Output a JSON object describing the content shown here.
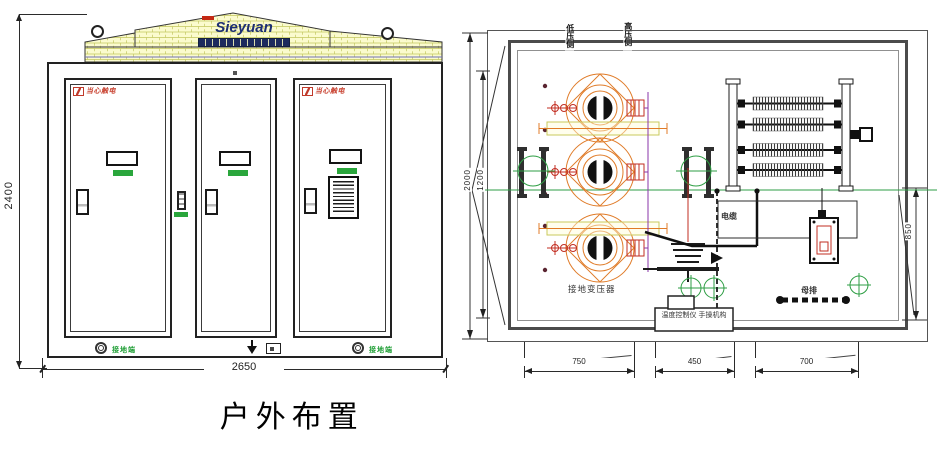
{
  "title": "户外布置",
  "front": {
    "logo": "Sieyuan",
    "dim_height": "2400",
    "dim_width": "2650",
    "warning": "当心触电",
    "ground_label": "接地端"
  },
  "plan": {
    "dim_total_height": "2000",
    "dim_inner_height": "1200",
    "dim_right_height": "850",
    "dim_bottom_1": "750",
    "dim_bottom_2": "450",
    "dim_bottom_3": "700",
    "top_label_left": "低压侧",
    "top_label_right": "高压侧",
    "cable_label": "电缆",
    "bus_label": "母排",
    "transformer_label": "接地变压器",
    "control_label": "温度控制仪 手操机构"
  },
  "colors": {
    "line": "#2b2b2b",
    "brick_fill": "#fbfbce",
    "brick_joint": "#c3c75f",
    "logo_blue": "#1d2f73",
    "warning_red": "#c8402e",
    "indicator_green": "#2aa63c",
    "centerline_green": "#2e9e44",
    "coil_orange": "#e07b28",
    "bushing_red": "#c22e22",
    "connector_purple": "#8a36aa",
    "wall_gray": "#4b4b4b"
  }
}
